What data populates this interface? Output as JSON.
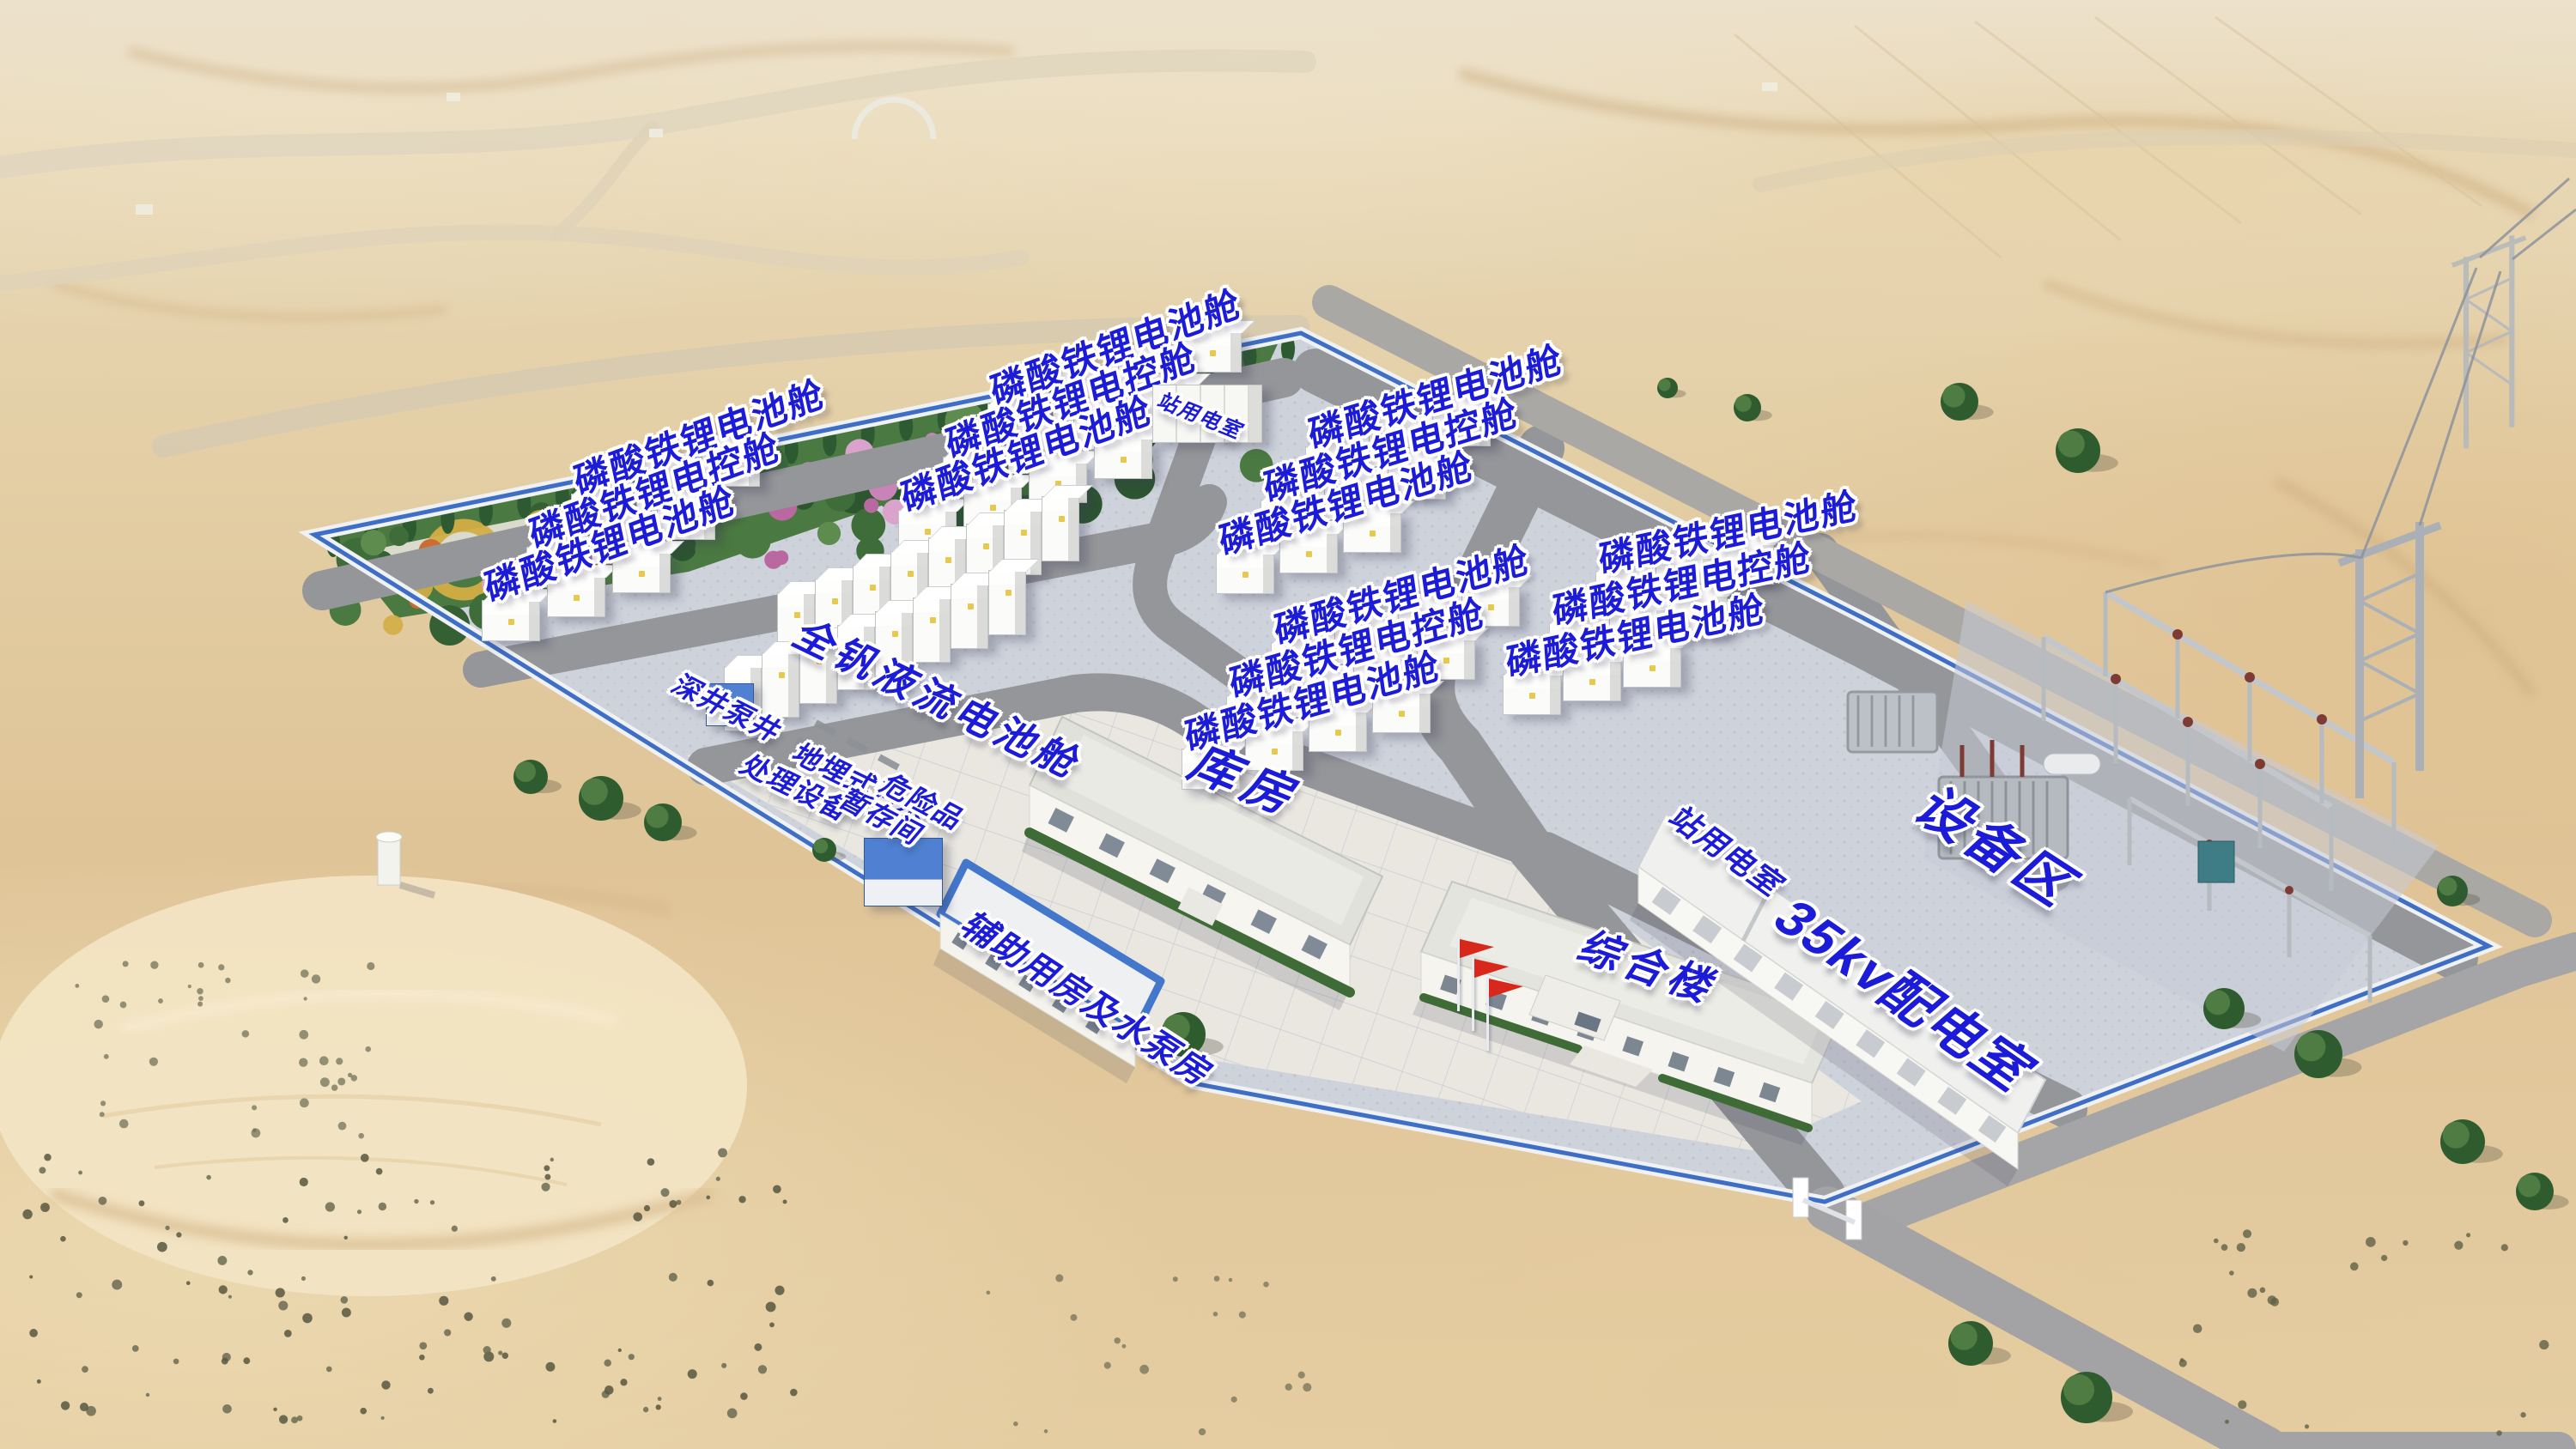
{
  "colors": {
    "label_blue": "#1b1bd8",
    "label_halo": "#ffffff",
    "fence_blue": "#3e6ec5",
    "fence_wall": "#eff1f3",
    "road_gray": "#95969a",
    "site_gravel": "#ced2db",
    "pavement": "#e9e7e0",
    "sand": "#e2c99e",
    "garden_green": "#4a7a41",
    "hedge_green": "#3f6b37",
    "flag_red": "#d8281c",
    "blue_roof": "#4f80d2",
    "building_wall": "#f5f4ef",
    "roof_gray": "#e0e1db"
  },
  "battery_blocks": [
    {
      "id": "block-west",
      "rows": [
        "磷酸铁锂电池舱",
        "磷酸铁锂电控舱",
        "磷酸铁锂电池舱"
      ]
    },
    {
      "id": "block-north-mid",
      "rows": [
        "磷酸铁锂电池舱",
        "磷酸铁锂电控舱",
        "磷酸铁锂电池舱"
      ]
    },
    {
      "id": "block-north-east",
      "rows": [
        "磷酸铁锂电池舱",
        "磷酸铁锂电控舱",
        "磷酸铁锂电池舱"
      ]
    },
    {
      "id": "block-east",
      "rows": [
        "磷酸铁锂电池舱",
        "磷酸铁锂电控舱",
        "磷酸铁锂电池舱"
      ]
    },
    {
      "id": "block-center",
      "rows": [
        "磷酸铁锂电池舱",
        "磷酸铁锂电控舱",
        "磷酸铁锂电池舱"
      ]
    }
  ],
  "flow_battery_block": {
    "label": "全钒液流电池舱"
  },
  "facility_labels": {
    "station_power_room_top": "站用电室",
    "deep_well_pump": "深井泵井",
    "underground_sewage_line1": "地埋式污水",
    "underground_sewage_line2": "处理设备",
    "hazardous_storage_line1": "危险品",
    "hazardous_storage_line2": "暂存间",
    "auxiliary_pump_house": "辅助用房及水泵房",
    "warehouse": "库房",
    "complex_building": "综合楼",
    "station_power_room_right": "站用电室",
    "distribution_room_35kv": "35kv配电室",
    "equipment_area": "设备区"
  }
}
